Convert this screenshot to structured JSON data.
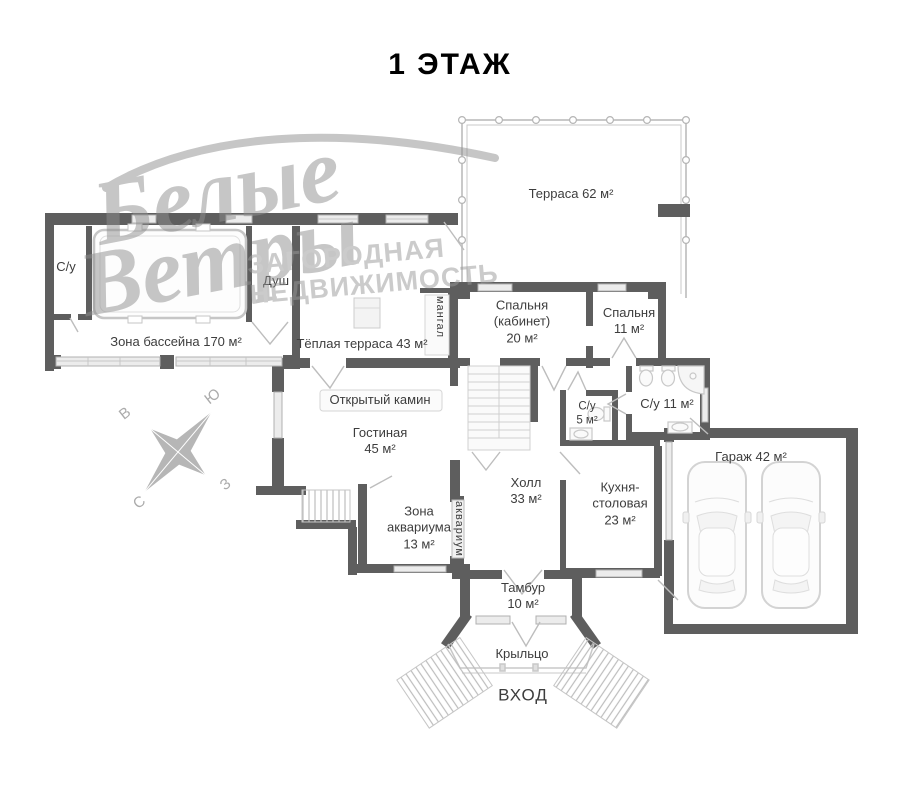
{
  "title": "1 ЭТАЖ",
  "watermark": {
    "script_line1": "Белые",
    "script_line2": "Ветры",
    "caps_line1": "ЗАГОРОДНАЯ",
    "caps_line2": "НЕДВИЖИМОСТЬ"
  },
  "compass": {
    "east": "В",
    "south": "Ю",
    "west": "З",
    "north": "С"
  },
  "colors": {
    "wall": "#5e5e5e",
    "light_fixture": "#cccccc",
    "label_text": "#3d3d3d",
    "watermark_gray": "#999999"
  },
  "rooms": {
    "terrace": {
      "label": "Терраса 62 м²"
    },
    "pool_zone": {
      "label": "Зона бассейна 170 м²"
    },
    "wc_pool": {
      "label": "С/у"
    },
    "shower": {
      "label": "Душ"
    },
    "warm_terrace": {
      "label": "Тёплая терраса 43 м²"
    },
    "mangal": {
      "label": "мангал"
    },
    "bedroom_office": {
      "label": "Спальня\n(кабинет)\n20 м²"
    },
    "bedroom": {
      "label": "Спальня\n11 м²"
    },
    "fireplace": {
      "label": "Открытый камин"
    },
    "living_room": {
      "label": "Гостиная\n45 м²"
    },
    "wc_small": {
      "label": "С/у\n5 м²"
    },
    "wc_large": {
      "label": "С/у 11 м²"
    },
    "hall": {
      "label": "Холл\n33 м²"
    },
    "kitchen": {
      "label": "Кухня-\nстоловая\n23 м²"
    },
    "garage": {
      "label": "Гараж 42 м²"
    },
    "aquarium_zone": {
      "label": "Зона\nаквариума\n13 м²"
    },
    "aquarium": {
      "label": "аквариум"
    },
    "tambour": {
      "label": "Тамбур\n10 м²"
    },
    "porch": {
      "label": "Крыльцо"
    },
    "entrance": {
      "label": "ВХОД"
    }
  }
}
